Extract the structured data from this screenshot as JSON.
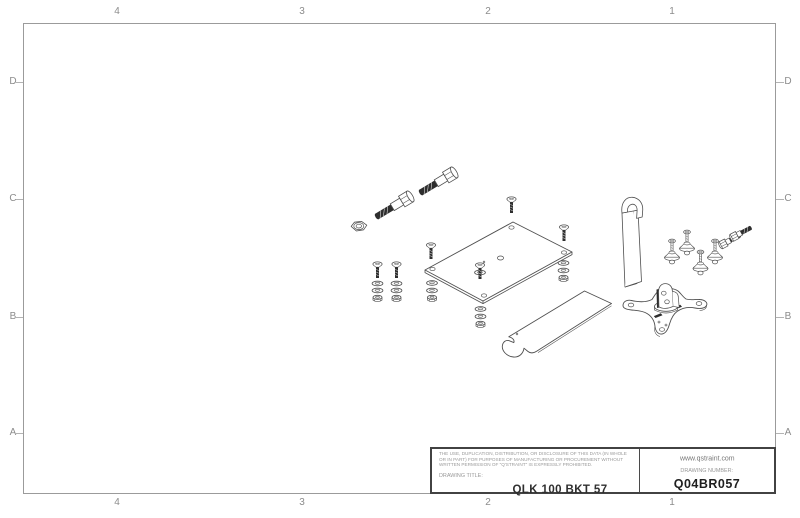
{
  "frame": {
    "columns": [
      "4",
      "3",
      "2",
      "1"
    ],
    "rows": [
      "D",
      "C",
      "B",
      "A"
    ]
  },
  "title_block": {
    "legal_notice": "THE USE, DUPLICATION, DISTRIBUTION, OR DISCLOSURE OF THIS DATA (IN WHOLE OR IN PART) FOR PURPOSES OF MANUFACTURING OR PROCUREMENT WITHOUT WRITTEN PERMISSION OF \"Q'STRAINT\" IS EXPRESSLY PROHIBITED.",
    "drawing_title_label": "DRAWING TITLE:",
    "drawing_title": "QLK 100 BKT 57",
    "website": "www.qstraint.com",
    "drawing_number_label": "DRAWING NUMBER:",
    "drawing_number": "Q04BR057"
  },
  "colors": {
    "sheet_background": "#ffffff",
    "frame_border": "#9b9b9b",
    "line_work": "#4f4f4f",
    "dark_fill": "#2e2e2e",
    "zone_label_text": "#8c8c8c",
    "title_text": "#2f2f2f"
  }
}
